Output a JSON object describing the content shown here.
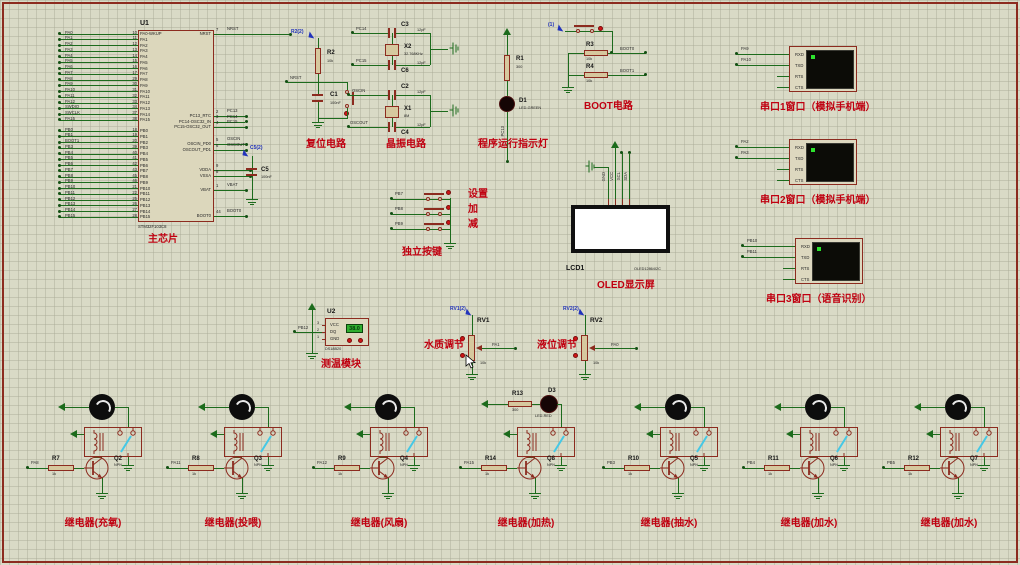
{
  "colors": {
    "wire_green": "#1c6b1c",
    "component_red": "#8c2b1f",
    "caption_red": "#c00010",
    "probe_blue": "#2233bb",
    "screen_black": "#0c0c07",
    "display_green": "#2fae2f",
    "canvas": "#d9dac6"
  },
  "chip": {
    "ref": "U1",
    "model": "STM32F103C8",
    "caption": "主芯片",
    "pa_pins": [
      {
        "net": "PA0",
        "num": "10",
        "name": "PA0-WKUP"
      },
      {
        "net": "PA1",
        "num": "11",
        "name": "PA1"
      },
      {
        "net": "PA2",
        "num": "12",
        "name": "PA2"
      },
      {
        "net": "PA3",
        "num": "13",
        "name": "PA3"
      },
      {
        "net": "PA4",
        "num": "14",
        "name": "PA4"
      },
      {
        "net": "PA5",
        "num": "15",
        "name": "PA5"
      },
      {
        "net": "PA6",
        "num": "16",
        "name": "PA6"
      },
      {
        "net": "PA7",
        "num": "17",
        "name": "PA7"
      },
      {
        "net": "PA8",
        "num": "29",
        "name": "PA8"
      },
      {
        "net": "PA9",
        "num": "30",
        "name": "PA9"
      },
      {
        "net": "PA10",
        "num": "31",
        "name": "PA10"
      },
      {
        "net": "PA11",
        "num": "32",
        "name": "PA11"
      },
      {
        "net": "PA12",
        "num": "33",
        "name": "PA12"
      },
      {
        "net": "SWDIO",
        "num": "34",
        "name": "PA13"
      },
      {
        "net": "SWCLK",
        "num": "37",
        "name": "PA14"
      },
      {
        "net": "PA15",
        "num": "38",
        "name": "PA15"
      }
    ],
    "pb_pins": [
      {
        "net": "PB0",
        "num": "18",
        "name": "PB0"
      },
      {
        "net": "PB1",
        "num": "19",
        "name": "PB1"
      },
      {
        "net": "BOOT1",
        "num": "20",
        "name": "PB2"
      },
      {
        "net": "PB3",
        "num": "39",
        "name": "PB3"
      },
      {
        "net": "PB4",
        "num": "40",
        "name": "PB4"
      },
      {
        "net": "PB5",
        "num": "41",
        "name": "PB5"
      },
      {
        "net": "PB6",
        "num": "42",
        "name": "PB6"
      },
      {
        "net": "PB7",
        "num": "43",
        "name": "PB7"
      },
      {
        "net": "PB8",
        "num": "45",
        "name": "PB8"
      },
      {
        "net": "PB9",
        "num": "46",
        "name": "PB9"
      },
      {
        "net": "PB10",
        "num": "21",
        "name": "PB10"
      },
      {
        "net": "PB11",
        "num": "22",
        "name": "PB11"
      },
      {
        "net": "PB12",
        "num": "25",
        "name": "PB12"
      },
      {
        "net": "PB13",
        "num": "26",
        "name": "PB13"
      },
      {
        "net": "PB14",
        "num": "27",
        "name": "PB14"
      },
      {
        "net": "PB15",
        "num": "28",
        "name": "PB15"
      }
    ],
    "right_pins": [
      {
        "net": "NRST",
        "num": "7",
        "name": "NRST"
      },
      {
        "net": "PC13",
        "num": "2",
        "name": "PC13_RTC"
      },
      {
        "net": "PC14",
        "num": "3",
        "name": "PC14-OSC32_IN"
      },
      {
        "net": "PC15",
        "num": "4",
        "name": "PC15-OSC32_OUT"
      },
      {
        "net": "OSCIN",
        "num": "5",
        "name": "OSCIN_PD0"
      },
      {
        "net": "OSCOUT",
        "num": "6",
        "name": "OSCOUT_PD1"
      },
      {
        "net": "",
        "num": "9",
        "name": "VDDA"
      },
      {
        "net": "",
        "num": "8",
        "name": "VSSA"
      },
      {
        "net": "VBAT",
        "num": "1",
        "name": "VBAT"
      },
      {
        "net": "BOOT0",
        "num": "44",
        "name": "BOOT0"
      }
    ],
    "c5": {
      "ref": "C5",
      "val": "100nF",
      "probe": "C5(2)"
    }
  },
  "reset": {
    "caption": "复位电路",
    "probe": "R2(2)",
    "r_ref": "R2",
    "r_val": "10k",
    "c_ref": "C1",
    "c_val": "100nF",
    "net": "NRST"
  },
  "crystal": {
    "caption": "晶振电路",
    "x2": {
      "ref": "X2",
      "val": "32.768KHz",
      "c_top": "C3",
      "c_bot": "C6",
      "cap_val": "12pF",
      "net_top": "PC14",
      "net_bot": "PC15"
    },
    "x1": {
      "ref": "X1",
      "val": "8M",
      "c_top": "C2",
      "c_bot": "C4",
      "cap_val": "12pF",
      "net_top": "OSCIN",
      "net_bot": "OSCOUT"
    }
  },
  "indicator": {
    "caption": "程序运行指示灯",
    "r_ref": "R1",
    "r_val": "300",
    "d_ref": "D1",
    "d_type": "LED-GREEN",
    "net": "PC13"
  },
  "boot": {
    "caption": "BOOT电路",
    "probe": "(1)",
    "r3_ref": "R3",
    "r3_val": "10k",
    "net3": "BOOT0",
    "r4_ref": "R4",
    "r4_val": "10k",
    "net4": "BOOT1"
  },
  "buttons": {
    "caption": "独立按键",
    "rows": [
      {
        "net": "PB7",
        "label": "设置"
      },
      {
        "net": "PB8",
        "label": "加"
      },
      {
        "net": "PB9",
        "label": "减"
      }
    ]
  },
  "oled": {
    "ref": "LCD1",
    "model": "OLED12864I2C",
    "caption": "OLED显示屏",
    "pins": [
      "GND",
      "VCC",
      "SCL",
      "SDA"
    ]
  },
  "serial": {
    "pins": [
      "RXD",
      "TXD",
      "RTS",
      "CTS"
    ]
  },
  "serial_windows": [
    {
      "caption": "串口1窗口（模拟手机端）",
      "nets": [
        "PA9",
        "PA10"
      ]
    },
    {
      "caption": "串口2窗口（模拟手机端）",
      "nets": [
        "PA2",
        "PA3"
      ]
    },
    {
      "caption": "串口3窗口（语音识别）",
      "nets": [
        "PB10",
        "PB11"
      ]
    }
  ],
  "temp": {
    "ref": "U2",
    "model": "DS18B20",
    "caption": "测温模块",
    "net": "PB12",
    "reading": "38.0",
    "pins": [
      {
        "num": "3",
        "name": "VCC"
      },
      {
        "num": "2",
        "name": "DQ"
      },
      {
        "num": "1",
        "name": "GND"
      }
    ]
  },
  "pots": [
    {
      "ref": "RV1",
      "probe": "RV1(2)",
      "caption": "水质调节",
      "net": "PA1",
      "val": "10k"
    },
    {
      "ref": "RV2",
      "probe": "RV2(2)",
      "caption": "液位调节",
      "net": "PA0",
      "val": "10k"
    }
  ],
  "relays": [
    {
      "net": "PA8",
      "r": "R7",
      "r_val": "1k",
      "q": "Q2",
      "q_type": "NPN",
      "caption": "继电器(充氧)",
      "load": "motor"
    },
    {
      "net": "PA11",
      "r": "R8",
      "r_val": "1k",
      "q": "Q3",
      "q_type": "NPN",
      "caption": "继电器(投喂)",
      "load": "motor"
    },
    {
      "net": "PA12",
      "r": "R9",
      "r_val": "1k",
      "q": "Q4",
      "q_type": "NPN",
      "caption": "继电器(风扇)",
      "load": "motor"
    },
    {
      "net": "PA15",
      "r": "R14",
      "r_val": "1k",
      "q": "Q8",
      "q_type": "NPN",
      "caption": "继电器(加热)",
      "load": "led",
      "load_r": "R13",
      "load_r_val": "300",
      "load_d": "D3",
      "load_d_type": "LED-RED"
    },
    {
      "net": "PB3",
      "r": "R10",
      "r_val": "1k",
      "q": "Q5",
      "q_type": "NPN",
      "caption": "继电器(抽水)",
      "load": "motor"
    },
    {
      "net": "PB4",
      "r": "R11",
      "r_val": "1k",
      "q": "Q6",
      "q_type": "NPN",
      "caption": "继电器(加水)",
      "load": "motor"
    },
    {
      "net": "PB5",
      "r": "R12",
      "r_val": "1k",
      "q": "Q7",
      "q_type": "NPN",
      "caption": "继电器(加水)",
      "load": "motor"
    }
  ]
}
